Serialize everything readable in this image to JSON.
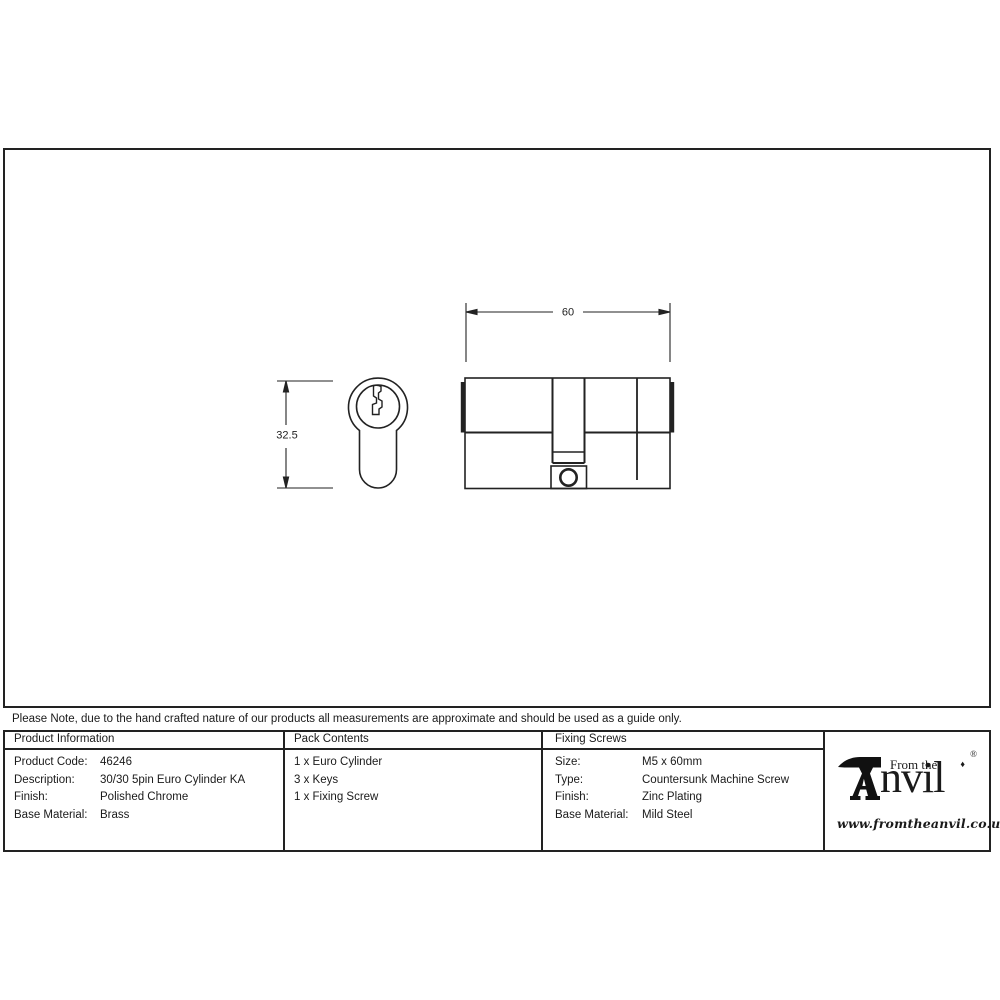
{
  "note": "Please Note, due to the hand crafted nature of our products all measurements are approximate and should be used as a guide only.",
  "drawing": {
    "width_dim": "60",
    "height_dim": "32.5"
  },
  "product_information": {
    "header": "Product Information",
    "rows": [
      {
        "label": "Product Code:",
        "value": "46246"
      },
      {
        "label": "Description:",
        "value": "30/30 5pin Euro Cylinder KA"
      },
      {
        "label": "Finish:",
        "value": "Polished Chrome"
      },
      {
        "label": "Base Material:",
        "value": "Brass"
      }
    ]
  },
  "pack_contents": {
    "header": "Pack Contents",
    "items": [
      "1 x Euro Cylinder",
      "3 x Keys",
      "1 x Fixing Screw"
    ]
  },
  "fixing_screws": {
    "header": "Fixing Screws",
    "rows": [
      {
        "label": "Size:",
        "value": "M5 x 60mm"
      },
      {
        "label": "Type:",
        "value": "Countersunk Machine Screw"
      },
      {
        "label": "Finish:",
        "value": "Zinc Plating"
      },
      {
        "label": "Base Material:",
        "value": "Mild Steel"
      }
    ]
  },
  "logo": {
    "from_the": "From the",
    "diamond": "♦",
    "brand_rest": "nvil",
    "registered": "®",
    "url": "www.fromtheanvil.co.uk"
  },
  "colors": {
    "line": "#222222",
    "background": "#ffffff"
  }
}
